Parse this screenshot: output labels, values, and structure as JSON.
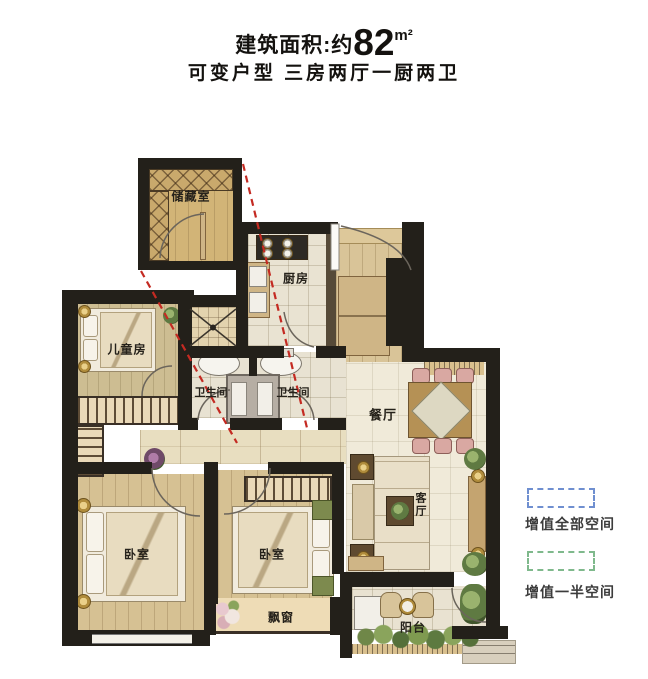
{
  "title": {
    "prefix": "建筑面积:约",
    "area": "82",
    "unit": "m²"
  },
  "subtitle": "可变户型 三房两厅一厨两卫",
  "inset": {
    "label": "储藏室"
  },
  "rooms": {
    "kids": "儿童房",
    "kitchen": "厨房",
    "bath_left": "卫生间",
    "bath_right": "卫生间",
    "dining": "餐厅",
    "living": "客厅",
    "bedroom_left": "卧室",
    "bedroom_mid": "卧室",
    "bay_window": "飘窗",
    "balcony": "阳台"
  },
  "legend": {
    "full": {
      "label": "增值全部空间",
      "color": "#6f8fd0"
    },
    "half": {
      "label": "增值一半空间",
      "color": "#7fb98c"
    }
  },
  "colors": {
    "wall": "#23201a",
    "wood_floor": "#d6c193",
    "tile_floor": "#f0ead9",
    "callout_line": "#c42a22"
  }
}
